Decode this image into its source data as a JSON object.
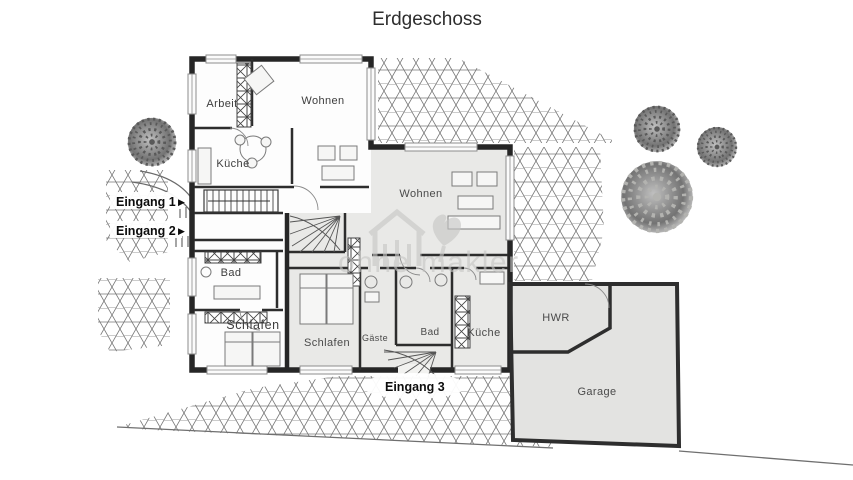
{
  "title": "Erdgeschoss",
  "watermark": {
    "text": "ohne makler"
  },
  "icons": {
    "entrance_arrow": "▶"
  },
  "labels": {
    "arbeit": "Arbeit",
    "wohnen_left": "Wohnen",
    "kueche_left": "Küche",
    "bad_left": "Bad",
    "schlafen_left": "Schlafen",
    "wohnen_right": "Wohnen",
    "schlafen_right": "Schlafen",
    "gaeste": "Gäste",
    "bad_right": "Bad",
    "kueche_right": "Küche",
    "hwr": "HWR",
    "garage": "Garage",
    "eingang1": "Eingang 1",
    "eingang2": "Eingang 2",
    "eingang3": "Eingang 3"
  },
  "colors": {
    "background": "#ffffff",
    "wall": "#262626",
    "unit2_fill": "#e9e9e7",
    "garage_fill": "#e3e3e1",
    "paving_line": "#6f6f6f",
    "watermark": "#c7c7c5",
    "title_text": "#2e2e2e",
    "label_text": "#3d3d3d"
  }
}
